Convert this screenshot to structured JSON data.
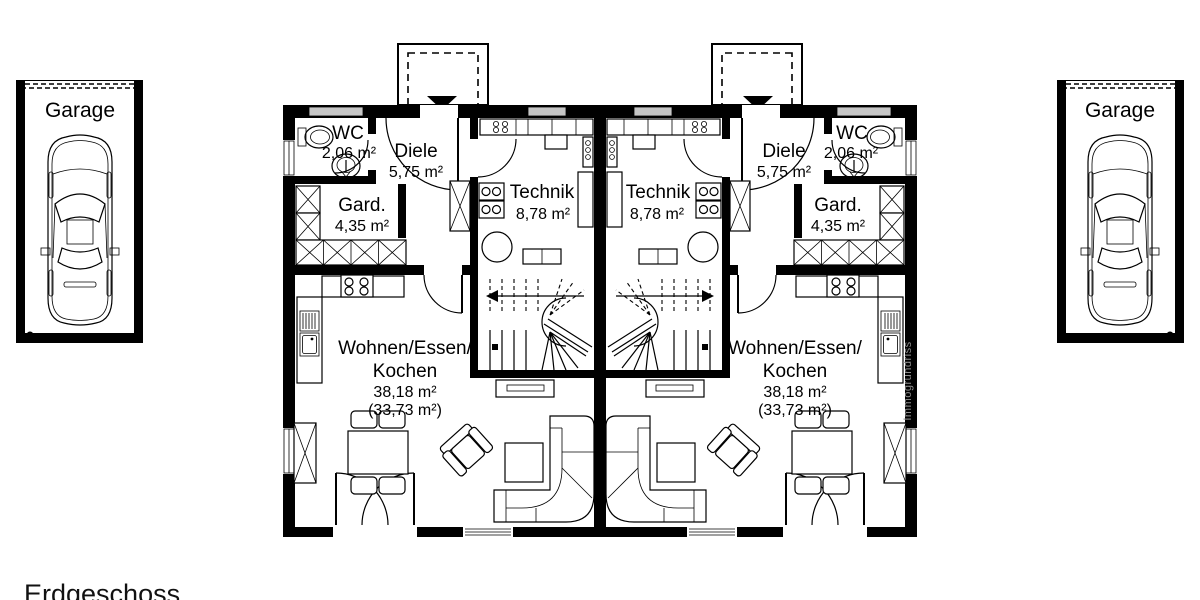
{
  "floor": {
    "title": "Erdgeschoss"
  },
  "watermark": "Immogrundriss",
  "garage": {
    "label": "Garage"
  },
  "rooms": {
    "wc": {
      "label": "WC",
      "area": "2,06 m²"
    },
    "diele": {
      "label": "Diele",
      "area": "5,75 m²"
    },
    "gard": {
      "label": "Gard.",
      "area": "4,35 m²"
    },
    "technik": {
      "label": "Technik",
      "area": "8,78 m²"
    },
    "wohnen": {
      "label_line1": "Wohnen/Essen/",
      "label_line2": "Kochen",
      "area": "38,18 m²",
      "area_secondary": "(33,73 m²)"
    }
  },
  "colors": {
    "walls": "#000000",
    "background": "#ffffff",
    "window_band": "#c6c6c6",
    "watermark_text": "#8f8f8f"
  }
}
